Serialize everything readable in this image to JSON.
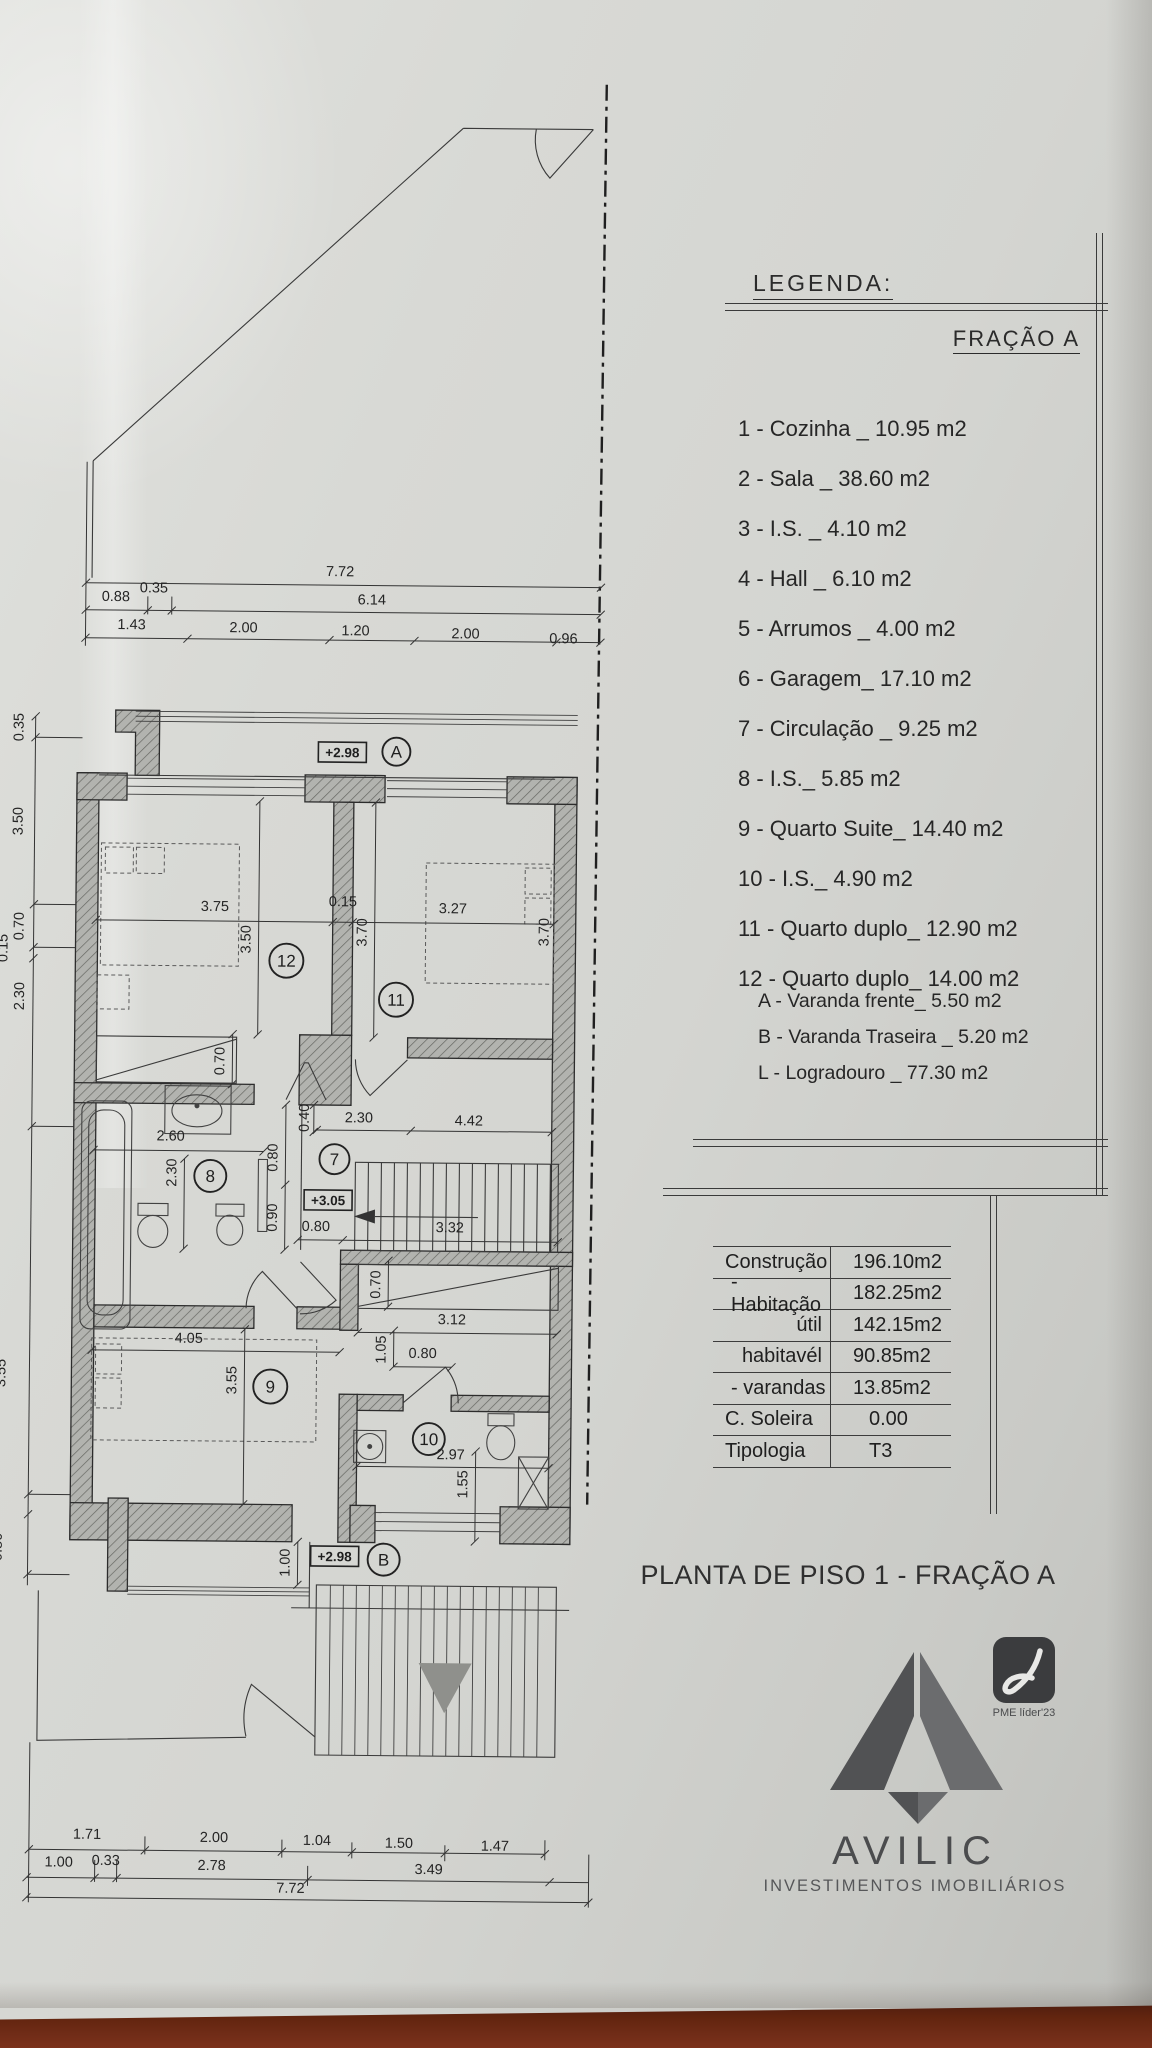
{
  "legend": {
    "heading": "LEGENDA:",
    "fraction": "FRAÇÃO A",
    "items": [
      "1 - Cozinha _ 10.95 m2",
      "2 - Sala _ 38.60 m2",
      "3 - I.S. _ 4.10 m2",
      "4 - Hall _ 6.10 m2",
      "5 - Arrumos _ 4.00 m2",
      "6 - Garagem_ 17.10 m2",
      "7 - Circulação _ 9.25 m2",
      "8 - I.S._ 5.85 m2",
      "9 - Quarto Suite_ 14.40 m2",
      "10 - I.S._ 4.90 m2",
      "11 - Quarto duplo_ 12.90 m2",
      "12 - Quarto duplo_ 14.00 m2"
    ],
    "sub_items": [
      "A - Varanda frente_ 5.50 m2",
      "B - Varanda Traseira _ 5.20 m2",
      "L - Logradouro _ 77.30 m2"
    ]
  },
  "areas_table": {
    "rows": [
      {
        "label": "Construção",
        "value": "196.10m2"
      },
      {
        "label": "- Habitação",
        "value": "182.25m2"
      },
      {
        "label": "útil",
        "value": "142.15m2"
      },
      {
        "label": "habitavél",
        "value": "90.85m2"
      },
      {
        "label": "- varandas",
        "value": "13.85m2"
      },
      {
        "label": "C. Soleira",
        "value": "0.00"
      },
      {
        "label": "Tipologia",
        "value": "T3"
      }
    ]
  },
  "plan": {
    "title": "PLANTA DE PISO 1 - FRAÇÃO A",
    "room_markers": [
      {
        "n": "A",
        "x": 394,
        "y": 751,
        "r": 14
      },
      {
        "n": "12",
        "x": 286,
        "y": 961,
        "r": 17
      },
      {
        "n": "11",
        "x": 396,
        "y": 999,
        "r": 17
      },
      {
        "n": "8",
        "x": 212,
        "y": 1177,
        "r": 16
      },
      {
        "n": "7",
        "x": 336,
        "y": 1159,
        "r": 15
      },
      {
        "n": "9",
        "x": 274,
        "y": 1387,
        "r": 17
      },
      {
        "n": "10",
        "x": 433,
        "y": 1438,
        "r": 16
      },
      {
        "n": "B",
        "x": 389,
        "y": 1559,
        "r": 16
      }
    ],
    "elevation_markers": [
      {
        "t": "+2.98",
        "x": 340,
        "y": 752
      },
      {
        "t": "+3.05",
        "x": 330,
        "y": 1200
      },
      {
        "t": "+2.98",
        "x": 340,
        "y": 1556
      }
    ],
    "dim_labels": [
      {
        "t": "7.72",
        "x": 336,
        "y": 576
      },
      {
        "t": "0.88",
        "x": 112,
        "y": 603
      },
      {
        "t": "0.35",
        "x": 150,
        "y": 594
      },
      {
        "t": "6.14",
        "x": 368,
        "y": 604
      },
      {
        "t": "1.43",
        "x": 128,
        "y": 631
      },
      {
        "t": "2.00",
        "x": 240,
        "y": 633
      },
      {
        "t": "1.20",
        "x": 352,
        "y": 635
      },
      {
        "t": "2.00",
        "x": 462,
        "y": 637
      },
      {
        "t": "0.96",
        "x": 560,
        "y": 641
      },
      {
        "t": "0.35",
        "x": 21,
        "y": 730,
        "r": -90
      },
      {
        "t": "3.50",
        "x": 21,
        "y": 824,
        "r": -90
      },
      {
        "t": "0.70",
        "x": 23,
        "y": 929,
        "r": -90
      },
      {
        "t": "0.15",
        "x": 7,
        "y": 951,
        "r": -90
      },
      {
        "t": "2.30",
        "x": 24,
        "y": 999,
        "r": -90
      },
      {
        "t": "3.55",
        "x": 9,
        "y": 1376,
        "r": -90
      },
      {
        "t": "0.80",
        "x": 7,
        "y": 1550,
        "r": -90
      },
      {
        "t": "3.75",
        "x": 214,
        "y": 912
      },
      {
        "t": "0.15",
        "x": 342,
        "y": 906
      },
      {
        "t": "3.27",
        "x": 452,
        "y": 912
      },
      {
        "t": "3.50",
        "x": 250,
        "y": 940,
        "r": -90
      },
      {
        "t": "3.70",
        "x": 366,
        "y": 932,
        "r": -90
      },
      {
        "t": "3.70",
        "x": 548,
        "y": 930,
        "r": -90
      },
      {
        "t": "0.70",
        "x": 225,
        "y": 1062,
        "r": -90
      },
      {
        "t": "2.60",
        "x": 172,
        "y": 1142
      },
      {
        "t": "2.30",
        "x": 178,
        "y": 1174,
        "r": -90
      },
      {
        "t": "0.40",
        "x": 310,
        "y": 1118,
        "r": -90
      },
      {
        "t": "2.30",
        "x": 360,
        "y": 1122
      },
      {
        "t": "4.42",
        "x": 470,
        "y": 1124
      },
      {
        "t": "0.80",
        "x": 279,
        "y": 1158,
        "r": -90
      },
      {
        "t": "0.90",
        "x": 279,
        "y": 1218,
        "r": -90
      },
      {
        "t": "0.80",
        "x": 318,
        "y": 1231
      },
      {
        "t": "3.32",
        "x": 452,
        "y": 1231
      },
      {
        "t": "0.70",
        "x": 383,
        "y": 1284,
        "r": -90
      },
      {
        "t": "3.12",
        "x": 455,
        "y": 1323
      },
      {
        "t": "1.05",
        "x": 389,
        "y": 1349,
        "r": -90
      },
      {
        "t": "0.80",
        "x": 426,
        "y": 1357
      },
      {
        "t": "4.05",
        "x": 192,
        "y": 1344
      },
      {
        "t": "3.55",
        "x": 240,
        "y": 1381,
        "r": -90
      },
      {
        "t": "2.97",
        "x": 455,
        "y": 1458
      },
      {
        "t": "1.55",
        "x": 472,
        "y": 1483,
        "r": -90
      },
      {
        "t": "1.00",
        "x": 295,
        "y": 1563,
        "r": -90
      },
      {
        "t": "1.71",
        "x": 95,
        "y": 1841
      },
      {
        "t": "2.00",
        "x": 222,
        "y": 1843
      },
      {
        "t": "1.04",
        "x": 325,
        "y": 1845
      },
      {
        "t": "1.50",
        "x": 407,
        "y": 1847
      },
      {
        "t": "1.47",
        "x": 503,
        "y": 1849
      },
      {
        "t": "1.00",
        "x": 67,
        "y": 1869
      },
      {
        "t": "0.33",
        "x": 114,
        "y": 1867
      },
      {
        "t": "2.78",
        "x": 220,
        "y": 1871
      },
      {
        "t": "3.49",
        "x": 437,
        "y": 1873
      },
      {
        "t": "7.72",
        "x": 299,
        "y": 1893
      }
    ]
  },
  "logo": {
    "name": "AVILIC",
    "tagline": "INVESTIMENTOS IMOBILIÁRIOS",
    "badge": "PME líder'23"
  },
  "colors": {
    "paper": "#d6d7d3",
    "ink": "#2e2e2e",
    "table_wood": "#6e2b18",
    "logo_gray_dark": "#515254",
    "logo_gray_light": "#6b6c6e"
  }
}
